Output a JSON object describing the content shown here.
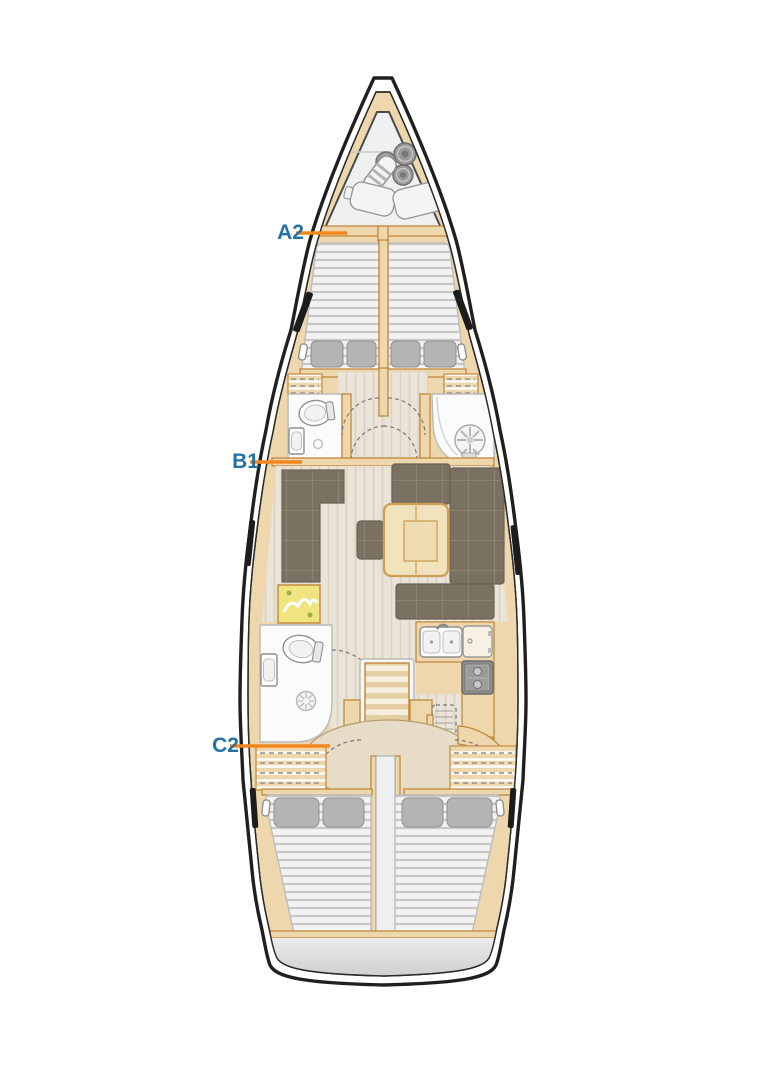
{
  "canvas": {
    "width": 764,
    "height": 1080,
    "background": "#ffffff"
  },
  "labels": [
    {
      "id": "A2",
      "text": "A2"
    },
    {
      "id": "B1",
      "text": "B1"
    },
    {
      "id": "C2",
      "text": "C2"
    }
  ],
  "colors": {
    "label_text": "#2472a4",
    "leader_line": "#f2871f",
    "hull_outline": "#1f1f1f",
    "wood": "#eed7ac",
    "wood_trim": "#c0883c",
    "floor": "#eae3d7",
    "sofa": "#7b7163",
    "mattress": "#f3f3f3",
    "pillow": "#b4b4b4",
    "bathroom": "#fbfbfb",
    "appliance_gray": "#a9a9a9",
    "transom_gray": "#d9d9d9",
    "map_yellow": "#efe480"
  }
}
